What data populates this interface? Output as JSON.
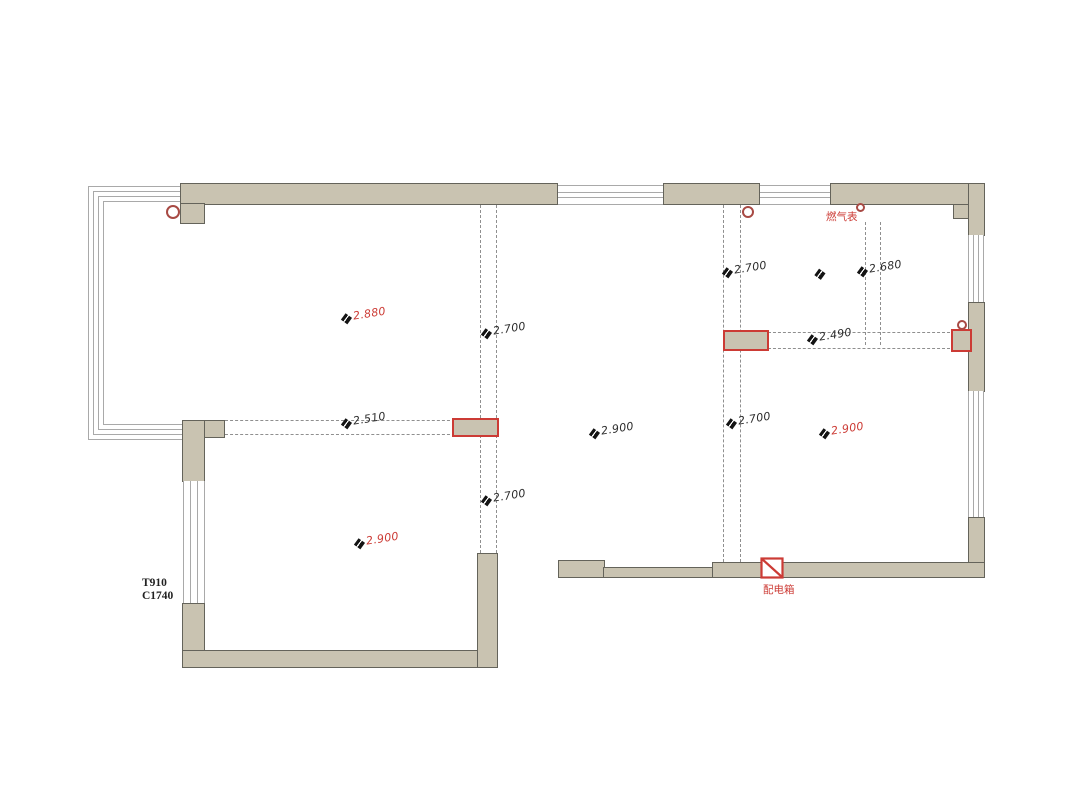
{
  "colors": {
    "wall_fill": "#c9c3b1",
    "wall_border": "#64635a",
    "window_line": "#a9a9a9",
    "dash": "#8f8f8f",
    "red": "#cc3b35",
    "ring": "#a84a44",
    "text": "#2d2d2d"
  },
  "dimensions": [
    {
      "text": "2.880",
      "color": "red"
    },
    {
      "text": "2.700",
      "color": "black"
    },
    {
      "text": "2.700",
      "color": "black"
    },
    {
      "text": "2.680",
      "color": "black"
    },
    {
      "text": "2.490",
      "color": "black"
    },
    {
      "text": "2.510",
      "color": "black"
    },
    {
      "text": "2.900",
      "color": "black"
    },
    {
      "text": "2.700",
      "color": "black"
    },
    {
      "text": "2.900",
      "color": "red"
    },
    {
      "text": "2.700",
      "color": "black"
    },
    {
      "text": "2.900",
      "color": "red"
    },
    {
      "text": "",
      "color": "black"
    }
  ],
  "annotations": {
    "gas_meter": "燃气表",
    "distribution_box": "配电箱",
    "window_code": [
      "T910",
      "C1740"
    ]
  }
}
